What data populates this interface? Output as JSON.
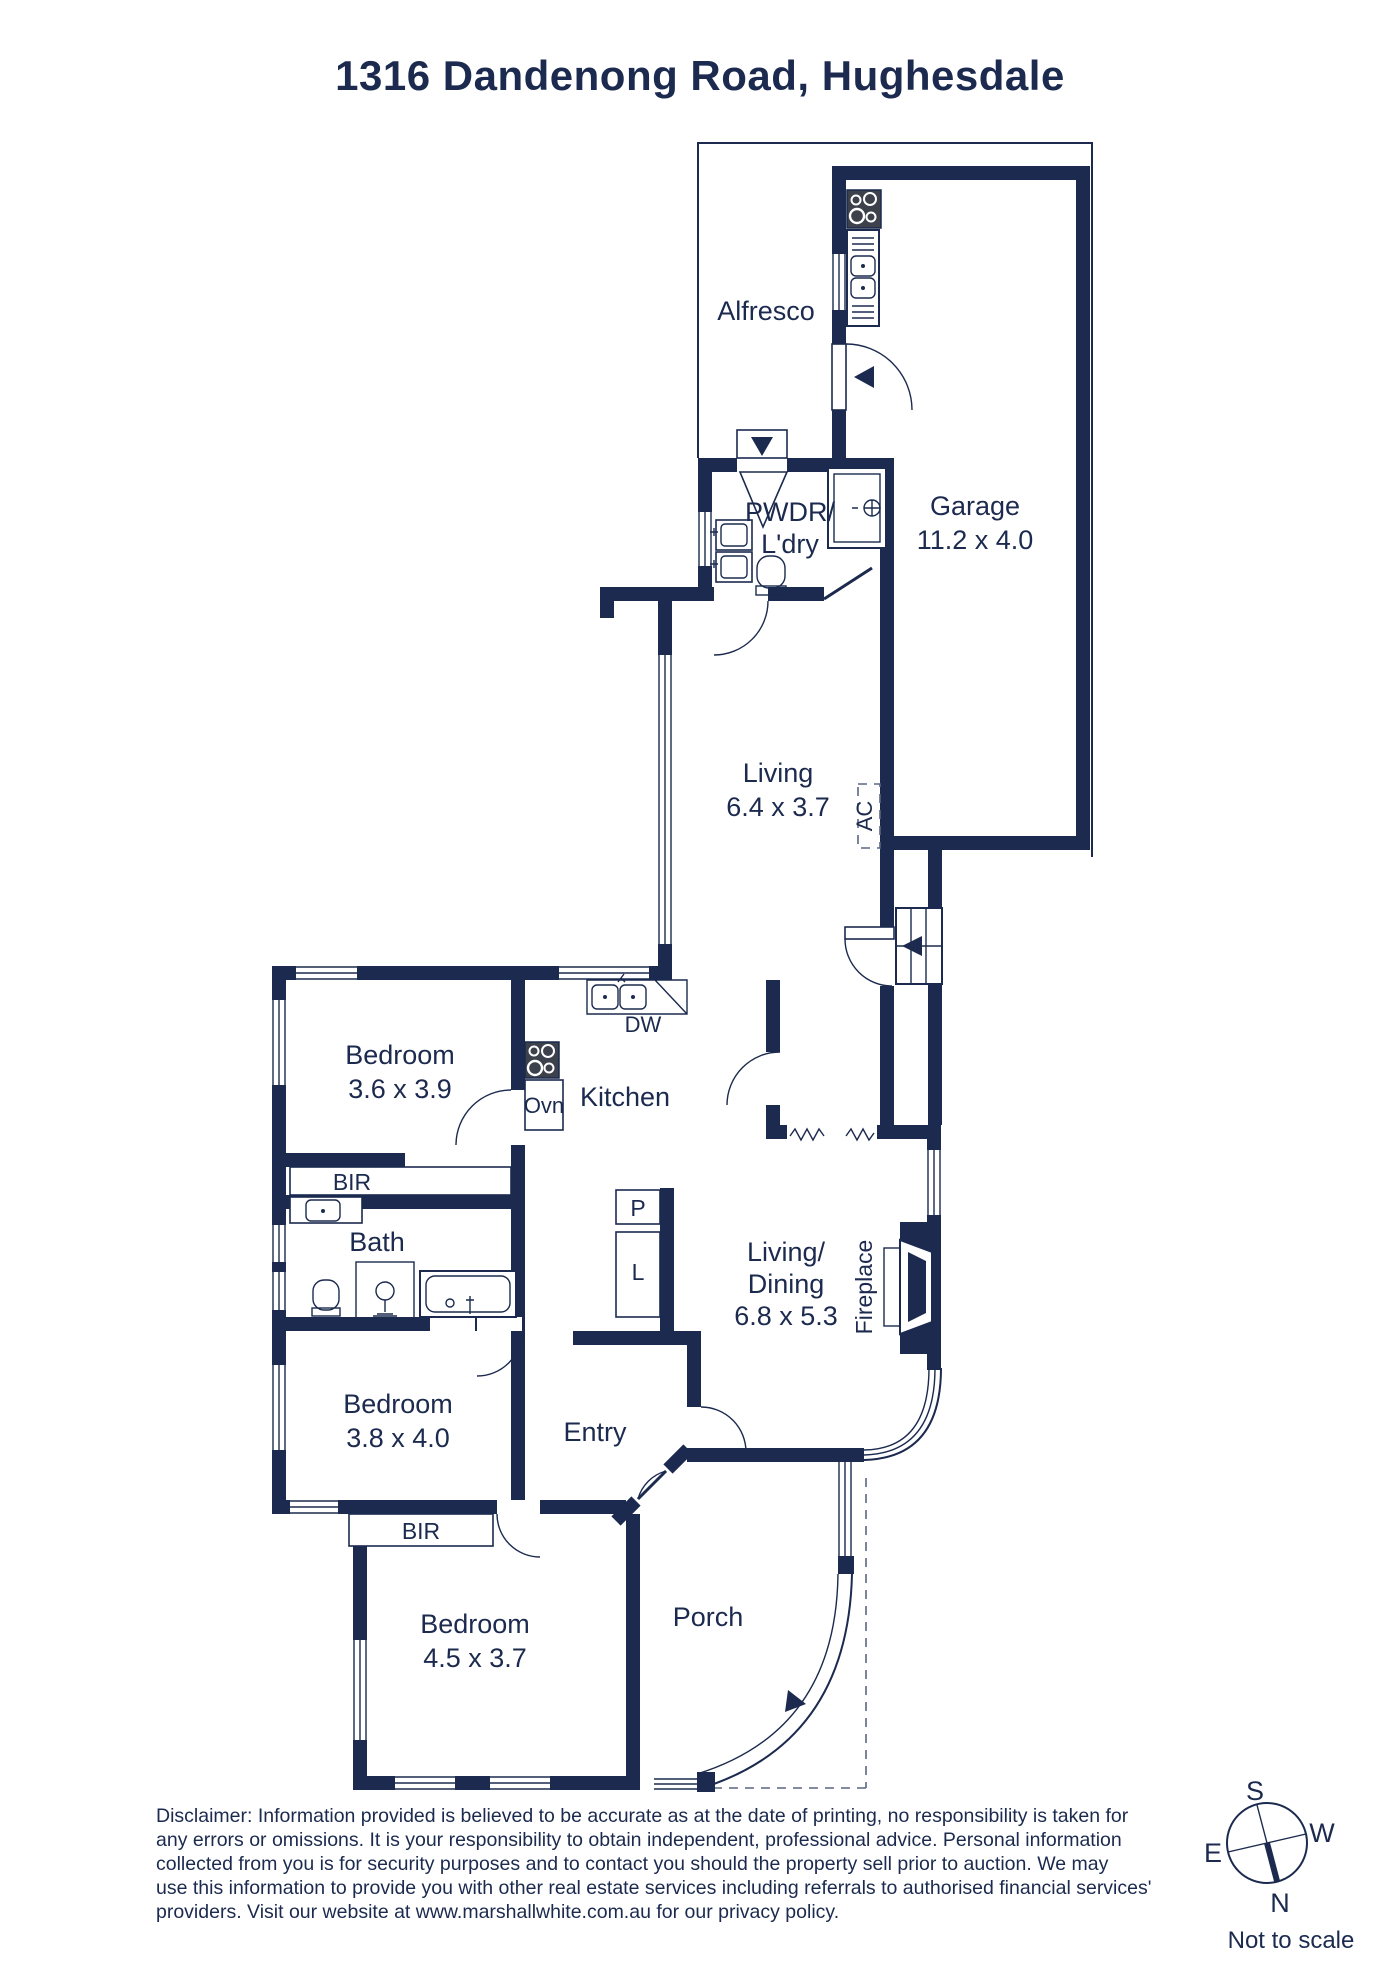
{
  "title": "1316 Dandenong Road, Hughesdale",
  "rooms": {
    "alfresco": {
      "label": "Alfresco"
    },
    "garage": {
      "label": "Garage",
      "dims": "11.2 x 4.0"
    },
    "pwdr_ldry": {
      "line1": "PWDR/",
      "line2": "L'dry"
    },
    "living": {
      "label": "Living",
      "dims": "6.4 x 3.7"
    },
    "bedroom1": {
      "label": "Bedroom",
      "dims": "3.6 x 3.9"
    },
    "kitchen": {
      "label": "Kitchen"
    },
    "bath": {
      "label": "Bath"
    },
    "living_dining": {
      "line1": "Living/",
      "line2": "Dining",
      "dims": "6.8 x 5.3"
    },
    "bedroom2": {
      "label": "Bedroom",
      "dims": "3.8 x 4.0"
    },
    "entry": {
      "label": "Entry"
    },
    "bedroom3": {
      "label": "Bedroom",
      "dims": "4.5 x 3.7"
    },
    "porch": {
      "label": "Porch"
    }
  },
  "features": {
    "dishwasher": "DW",
    "oven": "Ovn",
    "pantry": "P",
    "linen": "L",
    "air_conditioner": "AC",
    "robe1": "BIR",
    "robe2": "BIR",
    "fireplace": "Fireplace"
  },
  "compass": {
    "north": "N",
    "south": "S",
    "east": "E",
    "west": "W"
  },
  "footer": {
    "scale_note": "Not to scale",
    "disclaimer_lines": [
      "Disclaimer: Information provided is believed to be accurate as at the date of printing, no responsibility is taken for",
      "any errors or omissions. It is your responsibility to obtain independent, professional advice. Personal information",
      "collected from you is for security purposes and to contact you should the property sell prior to auction. We may",
      "use this information to provide you with other real estate services including referrals to authorised financial services'",
      "providers. Visit our website at www.marshallwhite.com.au for our privacy policy."
    ]
  },
  "colors": {
    "ink": "#1b2a4e",
    "cooktop": "#3c414b"
  }
}
